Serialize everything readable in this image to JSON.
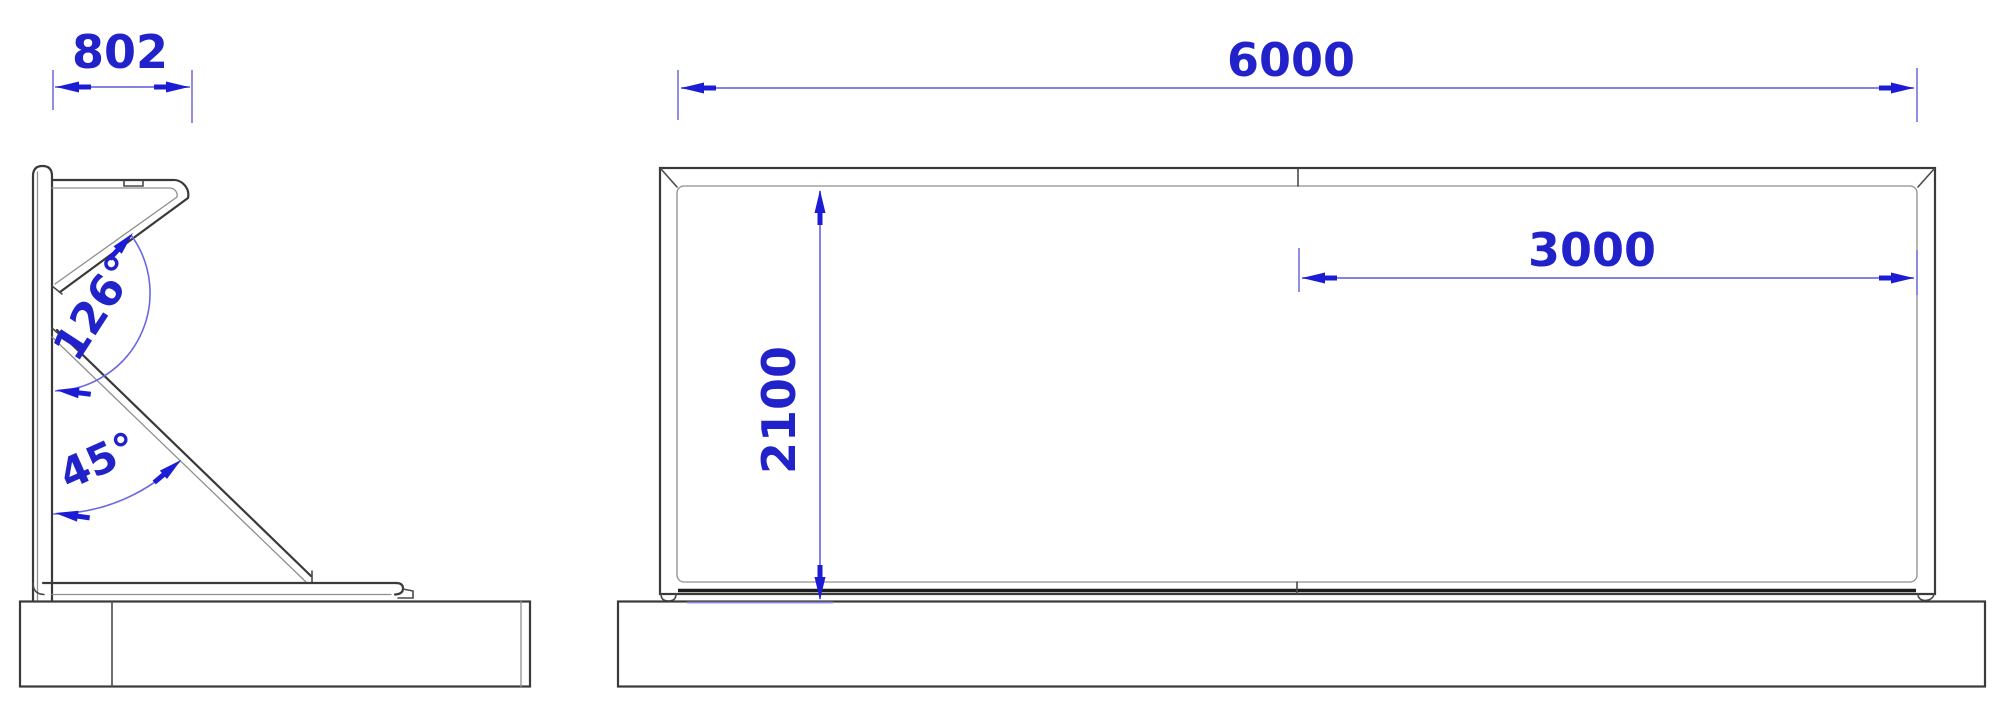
{
  "drawing": {
    "type": "technical-drawing",
    "background_color": "#ffffff",
    "colors": {
      "dimension_text": "#2222cb",
      "dimension_line": "#8282e4",
      "arrowhead": "#1c1cd4",
      "angle_arc": "#6a6ae0",
      "outline_primary": "#3a3a3a",
      "outline_secondary": "#8f8f8f"
    },
    "side_view": {
      "dim_width": {
        "label": "802"
      },
      "dim_angle_upper": {
        "label": "126°"
      },
      "dim_angle_lower": {
        "label": "45°"
      }
    },
    "front_view": {
      "dim_overall_width": {
        "label": "6000"
      },
      "dim_panel_width": {
        "label": "3000"
      },
      "dim_height": {
        "label": "2100"
      }
    }
  }
}
